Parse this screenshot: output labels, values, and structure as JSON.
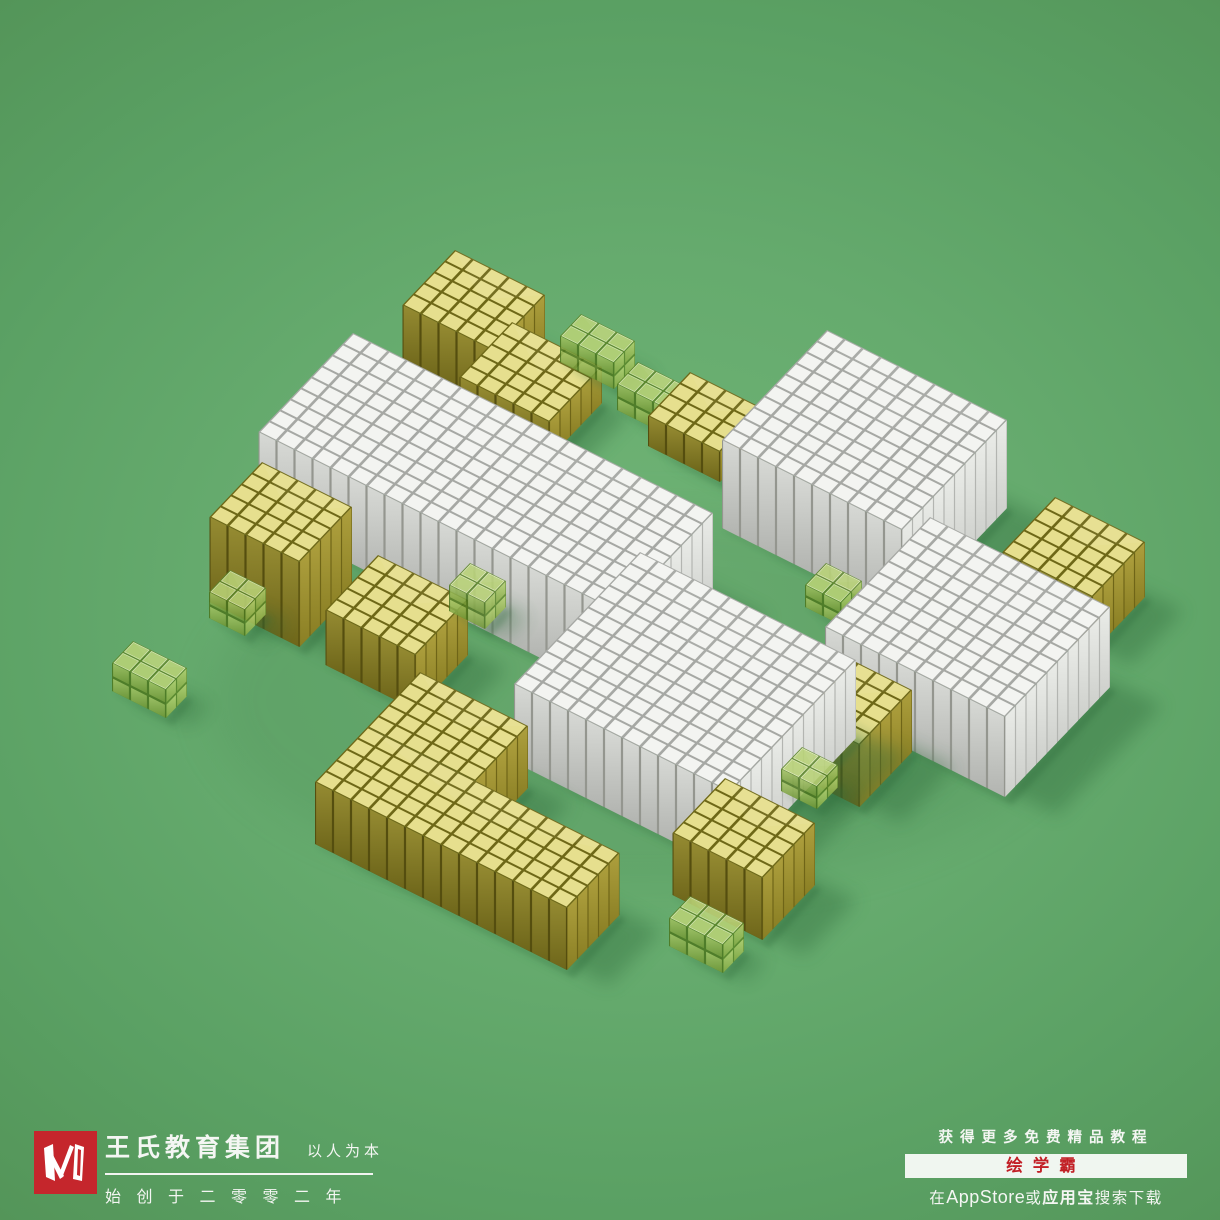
{
  "poster_title": "voxel-cube-composition",
  "background": {
    "center": "#70b476",
    "edge": "#4f8e55",
    "shadow": "#2e6a3a",
    "ao": "#3c7847"
  },
  "projection": {
    "u": [
      18,
      9
    ],
    "v": [
      -10.5,
      11
    ],
    "cellInset": 0.07,
    "slatInset": 0.06
  },
  "palettes": {
    "white": {
      "top": "#f3f4f1",
      "topGap": "#a6a8a4",
      "sw1": "#d7d9d5",
      "sw2": "#b2b4b0",
      "se1": "#eaece8",
      "se2": "#cdcfcb",
      "swGap": "#94968f",
      "seGap": "#b3b5b1",
      "opacity": 1
    },
    "yellow": {
      "top": "#e6df8e",
      "topGap": "#6e6817",
      "sw1": "#958b32",
      "sw2": "#6e661a",
      "se1": "#ad xxxx",
      "se2": "#8a7f24",
      "swGap": "#554e0f",
      "seGap": "#6f6517",
      "opacity": 1
    },
    "glass": {
      "top": "#b9d377",
      "topGap": "#5c8629",
      "sw1": "#a3c364",
      "sw2": "#6e9534",
      "se1": "#b6d373",
      "se2": "#84a942",
      "swGap": "#4c7720",
      "seGap": "#5b882a",
      "opacity": 0.87
    }
  },
  "blocks": [
    {
      "name": "yellow-cube-top",
      "type": "yellow",
      "n": [
        455,
        250
      ],
      "c": 5,
      "r": 5,
      "h": 58
    },
    {
      "name": "yellow-slab-upper",
      "type": "yellow",
      "n": [
        512,
        322
      ],
      "c": 5,
      "r": 5,
      "h": 36
    },
    {
      "name": "glass-top-1",
      "type": "glass",
      "n": [
        581,
        314
      ],
      "c": 3,
      "r": 2,
      "h": 26,
      "layers": 2
    },
    {
      "name": "glass-top-2",
      "type": "glass",
      "n": [
        638,
        362
      ],
      "c": 3,
      "r": 2,
      "h": 26,
      "layers": 2
    },
    {
      "name": "yellow-slab-mid",
      "type": "yellow",
      "n": [
        690,
        372
      ],
      "c": 4,
      "r": 4,
      "h": 30
    },
    {
      "name": "white-slab-long",
      "type": "white",
      "n": [
        353,
        333
      ],
      "c": 20,
      "r": 9,
      "h": 85
    },
    {
      "name": "white-block-topright",
      "type": "white",
      "n": [
        827,
        330
      ],
      "c": 10,
      "r": 10,
      "h": 88
    },
    {
      "name": "yellow-cube-left",
      "type": "yellow",
      "n": [
        262,
        462
      ],
      "c": 5,
      "r": 5,
      "h": 85
    },
    {
      "name": "glass-left-1",
      "type": "glass",
      "n": [
        230,
        570
      ],
      "c": 2,
      "r": 2,
      "h": 26,
      "layers": 2
    },
    {
      "name": "glass-left-2",
      "type": "glass",
      "n": [
        133,
        641
      ],
      "c": 3,
      "r": 2,
      "h": 28,
      "layers": 2
    },
    {
      "name": "yellow-cube-mid",
      "type": "yellow",
      "n": [
        378,
        555
      ],
      "c": 5,
      "r": 5,
      "h": 55
    },
    {
      "name": "glass-center",
      "type": "glass",
      "n": [
        470,
        563
      ],
      "c": 2,
      "r": 2,
      "h": 26,
      "layers": 2
    },
    {
      "name": "yellow-cube-right-far",
      "type": "yellow",
      "n": [
        1055,
        497
      ],
      "c": 5,
      "r": 5,
      "h": 55
    },
    {
      "name": "glass-right-1",
      "type": "glass",
      "n": [
        826,
        563
      ],
      "c": 2,
      "r": 2,
      "h": 22,
      "layers": 2
    },
    {
      "name": "white-block-right",
      "type": "white",
      "n": [
        930,
        517
      ],
      "c": 10,
      "r": 10,
      "h": 80
    },
    {
      "name": "yellow-cube-right-mid",
      "type": "yellow",
      "n": [
        822,
        645
      ],
      "c": 5,
      "r": 5,
      "h": 62
    },
    {
      "name": "white-cube-center",
      "type": "white",
      "n": [
        640,
        552
      ],
      "c": 12,
      "r": 12,
      "h": 78
    },
    {
      "name": "glass-right-2",
      "type": "glass",
      "n": [
        802,
        747
      ],
      "c": 2,
      "r": 2,
      "h": 22,
      "layers": 2
    },
    {
      "name": "yellow-L-upper",
      "type": "yellow",
      "n": [
        420,
        672
      ],
      "c": 6,
      "r": 5,
      "h": 62,
      "skipSW": true
    },
    {
      "name": "yellow-L-bar",
      "type": "yellow",
      "n": [
        367.5,
        727
      ],
      "c": 14,
      "r": 5,
      "h": 62
    },
    {
      "name": "yellow-cube-bottom",
      "type": "yellow",
      "n": [
        725,
        778
      ],
      "c": 5,
      "r": 5,
      "h": 62
    },
    {
      "name": "glass-bottom",
      "type": "glass",
      "n": [
        690,
        896
      ],
      "c": 3,
      "r": 2,
      "h": 28,
      "layers": 2
    }
  ],
  "footer": {
    "left": {
      "logo_letter": "W",
      "logo_color": "#c5262c",
      "company": "王氏教育集团",
      "motto": "以人为本",
      "slogan": "始创于二零零二年"
    },
    "right": {
      "line1": "获得更多免费精品教程",
      "badge": "绘学霸",
      "badge_color": "#c22026",
      "line3_prefix": "在",
      "line3_latin": "AppStore",
      "line3_mid": "或",
      "line3_app": "应用宝",
      "line3_suffix": "搜索下载"
    }
  }
}
